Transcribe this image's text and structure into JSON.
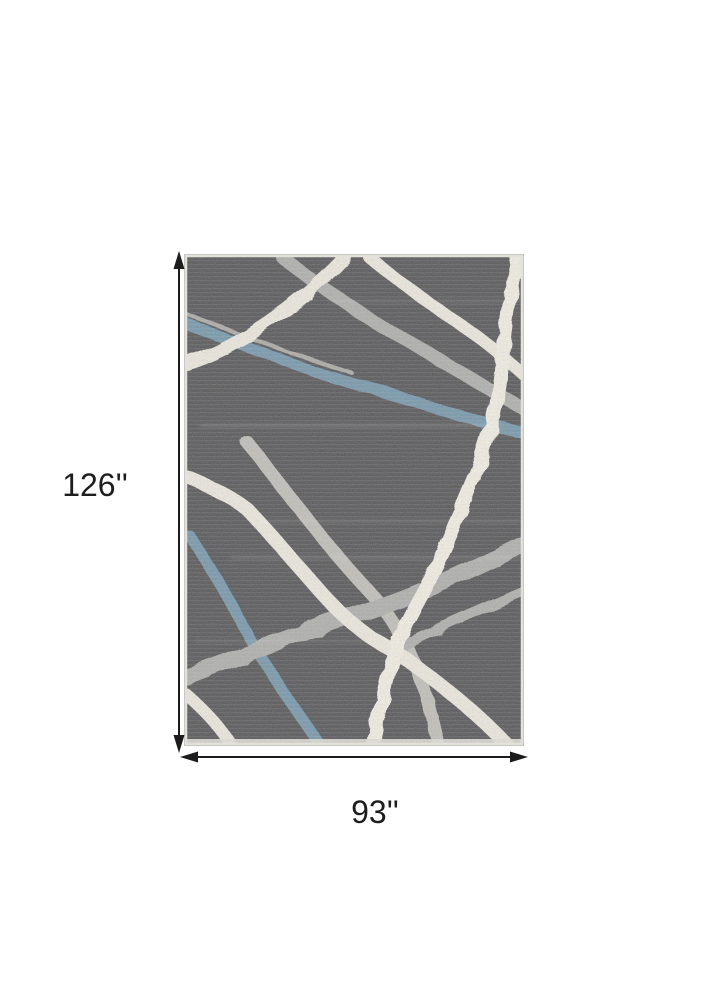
{
  "figure": {
    "kind": "rug dimension diagram",
    "description": "Dark charcoal distressed area rug with abstract cream, gray and blue ribbon stripes, annotated with height and width dimension arrows",
    "height_label": "126''",
    "width_label": "93''",
    "colors": {
      "page_background": "#ffffff",
      "dimension_line": "#1c1c1c",
      "rug_base": "#3a3a3c",
      "rug_edge": "#e3e1db",
      "stripe_blue": "#5e869c",
      "stripe_gray": "#a1a19e",
      "stripe_gray_light": "#b6b4ad",
      "stripe_cream": "#e9e5d8",
      "stripe_white": "#f0ecdf"
    }
  }
}
